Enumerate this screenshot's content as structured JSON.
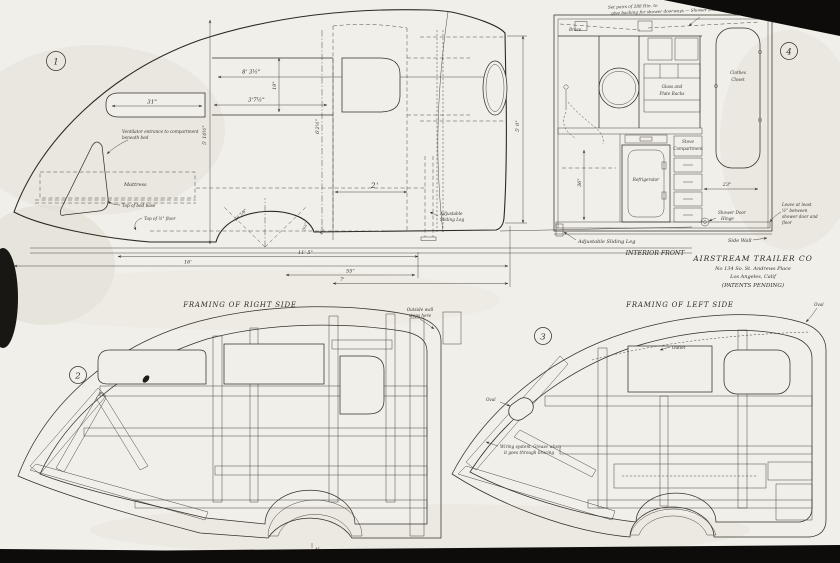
{
  "company": {
    "name": "AIRSTREAM TRAILER CO",
    "address": "No 134 So. St. Andrews Place",
    "city": "Los Angeles, Calif",
    "patents": "(PATENTS PENDING)"
  },
  "view1": {
    "number": "1",
    "notes": {
      "vent1": "Ventilator entrance to compartment",
      "vent2": "beneath bed",
      "mattress": "Mattress",
      "bed_base": "Top of bed base",
      "floor": "Top of ½\" floor",
      "leg1": "Adjustable",
      "leg2": "Sliding Leg"
    },
    "dims": {
      "front_window": "31\"",
      "upper_long": "8' 3½\"",
      "upper_short": "3'7½\"",
      "window_height": "19\"",
      "door_height": "6'2½\"",
      "door_to_wheel": "2'",
      "body_height": "5' 10½\"",
      "rear_height": "5' 0\"",
      "wheel_radius": "26 7/8\"",
      "wheel_a": "3¼\"",
      "wheel_b": "4½\"",
      "len_a": "11' 5\"",
      "overall": "16'",
      "len_b": "55\"",
      "len_c": "7'"
    }
  },
  "view4": {
    "number": "4",
    "notes": {
      "top1": "Set pairs of 288 Hin. to",
      "top2": "give backing for shower doorways — Shower Door Hinge",
      "brace": "Brace",
      "glass1": "Glass and",
      "glass2": "Plate Racks",
      "closet1": "Clothes",
      "closet2": "Closet",
      "stove1": "Stove",
      "stove2": "Compartment",
      "fridge": "Refrigerator",
      "hinge1": "Shower Door",
      "hinge2": "Hinge",
      "leave1": "Leave at least",
      "leave2": "½\" between",
      "leave3": "shower door and",
      "leave4": "floor",
      "leg": "Adjustable Sliding Leg",
      "side_wall": "Side Wall",
      "caption": "INTERIOR FRONT"
    },
    "dims": {
      "shelf": "23\"",
      "cabinet": "36\""
    }
  },
  "view2": {
    "number": "2",
    "title": "FRAMING OF RIGHT SIDE",
    "note1": "Outside wall",
    "note2": "stops here",
    "tiny_dim": "4\""
  },
  "view3": {
    "number": "3",
    "title": "FRAMING OF LEFT SIDE",
    "oval_rear": "Oval",
    "oval_nose": "Oval",
    "outlet": "Outlet",
    "wiring1": "Wiring system. Grease when",
    "wiring2": "it goes through bracing"
  }
}
